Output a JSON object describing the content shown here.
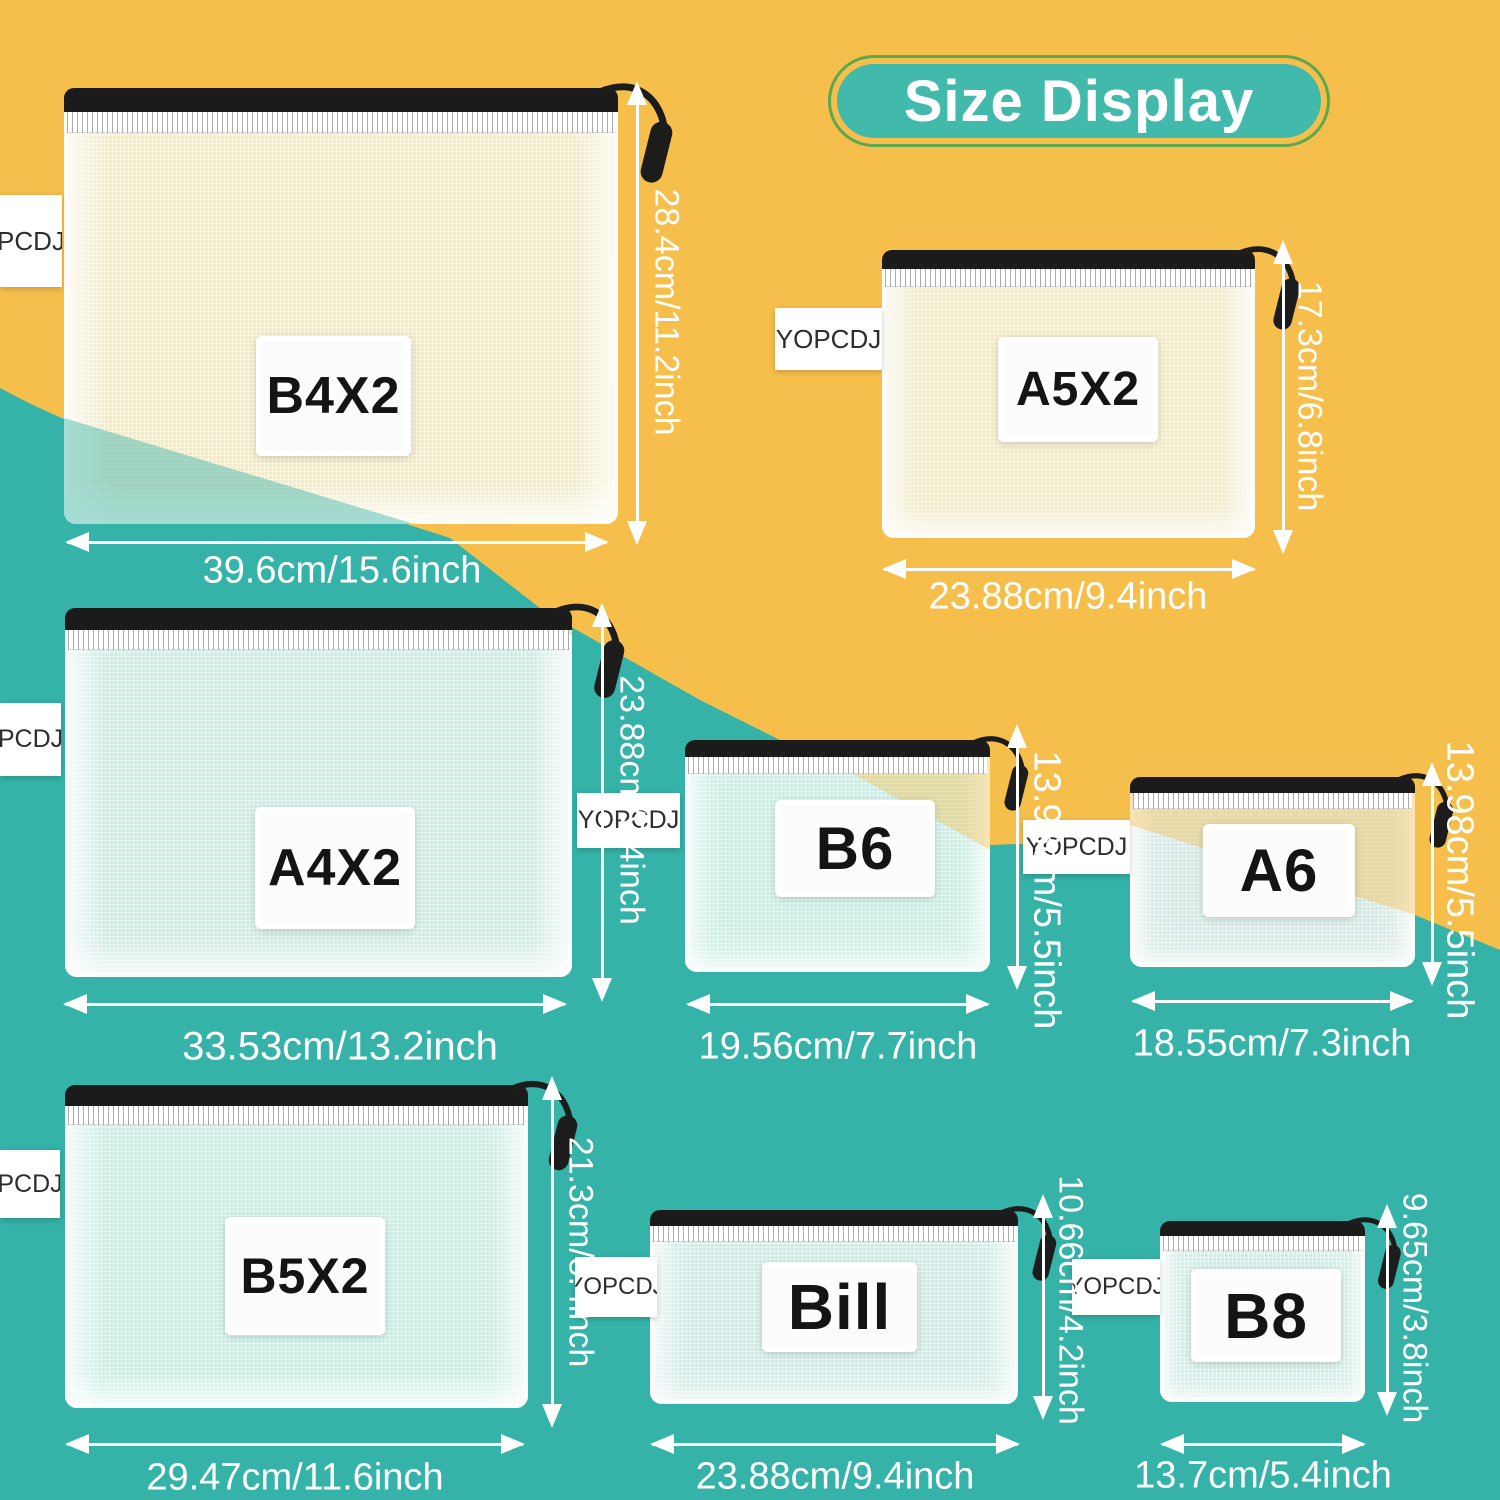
{
  "title": "Size Display",
  "bags": [
    {
      "id": "b4x2",
      "label": "B4X2",
      "tag": "PCDJ",
      "width_dim": "39.6cm/15.6inch",
      "height_dim": "28.4cm/11.2inch"
    },
    {
      "id": "a5x2",
      "label": "A5X2",
      "tag": "YOPCDJ",
      "width_dim": "23.88cm/9.4inch",
      "height_dim": "17.3cm/6.8inch"
    },
    {
      "id": "a4x2",
      "label": "A4X2",
      "tag": "PCDJ",
      "width_dim": "33.53cm/13.2inch",
      "height_dim": "23.88cm/9.4inch"
    },
    {
      "id": "b6",
      "label": "B6",
      "tag": "YOPCDJ",
      "width_dim": "19.56cm/7.7inch",
      "height_dim": "13.98cm/5.5inch"
    },
    {
      "id": "a6",
      "label": "A6",
      "tag": "YOPCDJ",
      "width_dim": "18.55cm/7.3inch",
      "height_dim": "13.98cm/5.5inch"
    },
    {
      "id": "b5x2",
      "label": "B5X2",
      "tag": "PCDJ",
      "width_dim": "29.47cm/11.6inch",
      "height_dim": "21.3cm/8.4inch"
    },
    {
      "id": "bill",
      "label": "Bill",
      "tag": "YOPCDJ",
      "width_dim": "23.88cm/9.4inch",
      "height_dim": "10.66cm/4.2inch"
    },
    {
      "id": "b8",
      "label": "B8",
      "tag": "YOPCDJ",
      "width_dim": "13.7cm/5.4inch",
      "height_dim": "9.65cm/3.8inch"
    }
  ],
  "colors": {
    "background_yellow": "#F6BF4C",
    "background_teal": "#35B3A8",
    "badge_fill": "#41B9AB",
    "badge_ring": "#5BA84E",
    "bag_cream": "#F2EBC6",
    "bag_mint": "#CFEBE4",
    "zipper_black": "#1B1B1B",
    "dimension_white": "#FFFFFF"
  }
}
